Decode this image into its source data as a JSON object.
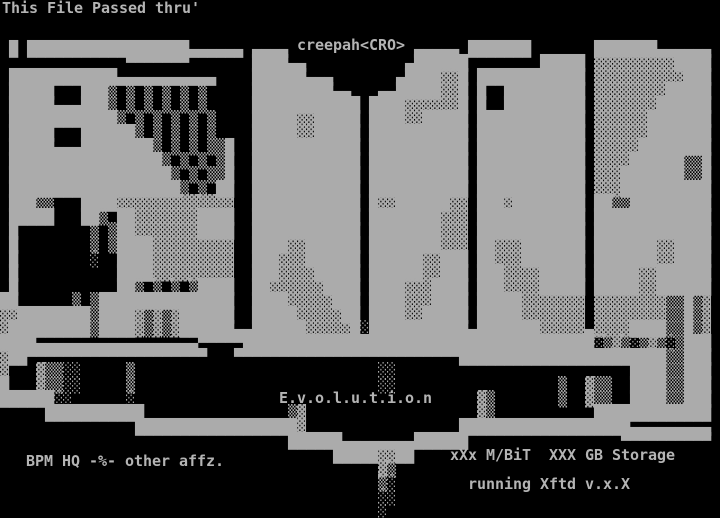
{
  "colors": {
    "background": "#000000",
    "foreground": "#ababab",
    "text": "#b4b4b4"
  },
  "texts": {
    "banner": "This File Passed thru'",
    "artist": "creepah<CRO>",
    "title": "E.v.o.l.u.t.i.o.n",
    "affils": "BPM HQ -%- other affz.",
    "stats": "xXx M/BiT  XXX GB Storage",
    "software": "running Xftd v.x.X"
  },
  "art": {
    "columns": 80,
    "rows": 37,
    "lines": [
      "",
      "",
      "",
      " █ ██████████████████▄▄▄▄▄▄ ▄▄▄▄              ▄▄▄▄▄ ███████       ███████▄▄▄▄▄▄ ",
      "              ▀▀▀▀▀▀▀       ████▄▄           ▄██████        █████ ▓▓▓▓▓▓▓▓▓████ ",
      " ████████████▄▄▄▄▄▄▄▄▄▄▄    ██████▄▄▄       ▄████▓▓█ ████████████ ▓▓▓▓▓▓▓▓▓▓███ ",
      " █████   ███▒ ▒ ▒ ▒ ▒ ▒     █████████▄▄   ▄▄█████▓▓█ █  █████████ ▓▓▓▓▓▓▓▓█████ ",
      " █████▄▄▄███▒ ▒ ▒ ▒ ▒ ▒     ████████████ ████▓▓▓▓▓▓█ █  █████████ ▓▓▓▓▓▓▓██████ ",
      " ████████████▒ ▒ ▒ ▒ ▒ ▒    █████▓▓█████ ████▓▓█████ ████████████ ▓▓▓▓▓▓███████ ",
      " █████   ██████▒ ▒ ▒ ▒ ▒    █████▓▓█████ ███████████ ████████████ ▓▓▓▓▓▓███████ ",
      " █████▄▄▄████████▒ ▒ ▒ ▒▒█  ████████████ ███████████ ████████████ ▓▓▓▓▓████████ ",
      " █████████████████▒ ▒ ▒ ▒█  ████████████ ███████████ ████████████ ▓▓▓▓██████▒▒█ ",
      " ██████████████████▒ ▒ ▒▒█  ████████████ ███████████ ████████████ ▓▓▓███████▒▒█ ",
      " ███████████████████▒ ▒ ██  ████████████ ███████████ ████████████ ▓▓▓██████████ ",
      " ███▒▒   ████▓▓▓▓▓▓▓▓▓▓▓▓▓  ████████████ █▓▓██████▓▓ ███▓████████ ██▒▒█████████ ",
      " █████   ██▒ ██▓▓▓▓▓▓▓████  ████████████ ████████▓▓▓ ████████████ █████████████ ",
      " █        ▒ ▒██▓▓▓▓▓▓▓████  ████████████ ████████▓▓▓ ████████████ █████████████ ",
      " █        ▒ ▒████▓▓▓▓▓▓▓▓▓  ████▓▓██████ ████████▓▓▓ ██▓▓▓███████ ███████▓▓████ ",
      " █        ░  ████▓▓▓▓▓▓▓▓▓  ███▓▓▓██████ ██████▓▓███ ██▓▓▓███████ ███████▓▓████ ",
      " █           ████▓▓▓▓▓▓▓▓▓  ███▓▓▓▓█████ ██████▓▓███ ███▓▓▓▓█████ █████▓▓██████ ",
      " █           ██▒ ▒ ▒ ▒████  ██▓▓▓▓▓▓████ ████▓▓▓████ ███▓▓▓▓█████ █████▓▓██████ ",
      "██      ▒ ▒███████████████  ████▓▓▓▓▓███ ████▓▓▓████ █████▓▓▓▓▓▓▓ ▓▓▓▓▓▓▓▓▒▒█▒▓ ",
      "▓▓████████▒████▓▒▓▒▓██████  █████▓▓▓▓▓██ ████▓▓█████ █████▓▓▓▓▓▓▓ ▓▓▓▓▓▓▓▓▒▒█▒▓ ",
      "▓█████████▒████▓▒▓▒▓██████▄▄██████▓▓▓▓▓█░███████████▄███████▓▓▓▓▓▄▓▓▓▓████▒▒█▒▓ ",
      "████▄▄▄▄▄▄▄▄▄▄▄▄▄▄▄▄▄▄▀▀▀▀▀███████████████████████████████████████░▒▓▒░▒▓▒░▒███ ",
      "▓██▀▀▀▀▀▀▀▀▀▀▀▀▀▀▀▀▀▀▀▀   ▀▀▀▀▀▀▀▀▀▀▀▀▀▀▀▀▀▀▀▀▀▀▀▀▀███████████████████████▒▒███ ",
      "▓   ▓▒▒░░     ▒                           ░░                          ████▒▒███ ",
      "█   ▓▒▒░░     ▒                           ░░                  ▒  ▓▒▒  ████▒▒███ ",
      "██████░░      ░                                      ▓▒       ▒  ▓▒▒  ████▒▒███ ",
      "     ███████████                ▒▓                   ▓▒           █████████████ ",
      "               ██████████████████▓                 ███████████████████▄▄▄▄▄▄▄▄▄ ",
      "                                ██████▄▄▄▄▄▄▄▄██████                 ▀▀▀▀▀▀▀▀▀▀ ",
      "                                     █████▓▓██                                  ",
      "                                          ▓▒                                    ",
      "                                          ▒░                                    ",
      "                                          ░░                                    ",
      "                                          ░                                     "
    ]
  }
}
